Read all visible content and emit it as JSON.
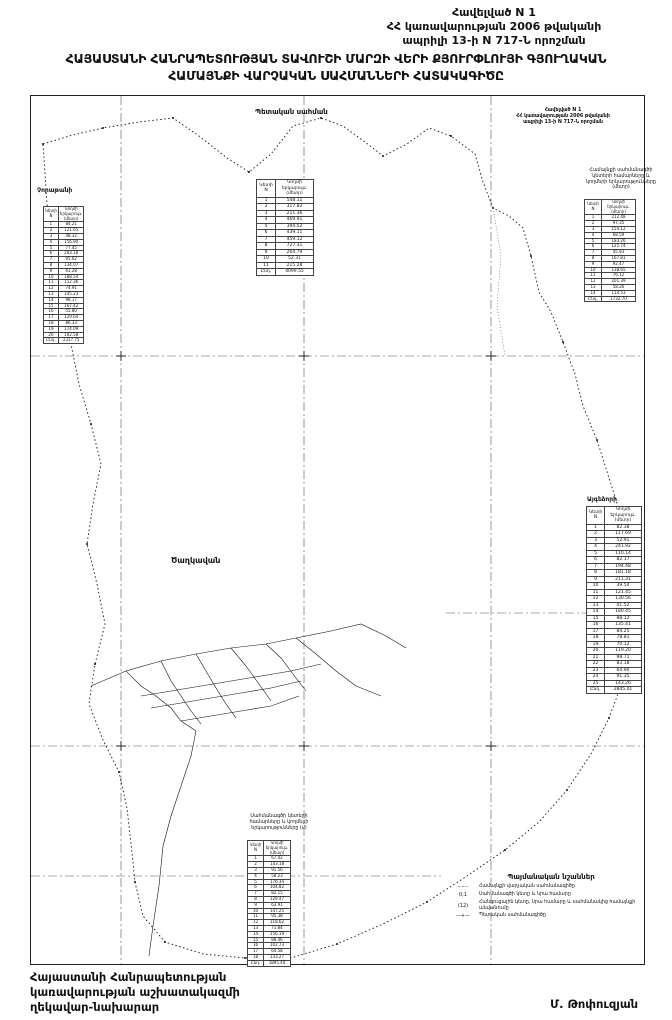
{
  "header": {
    "line1": "Հավելված N 1",
    "line2": "ՀՀ կառավարության 2006 թվականի",
    "line3": "ապրիլի 13-ի N 717-Ն որոշման"
  },
  "title": {
    "line1": "ՀԱՅԱՍՏԱՆԻ ՀԱՆՐԱՊԵՏՈՒԹՅԱՆ ՏԱՎՈՒՇԻ ՄԱՐԶԻ ՎԵՐԻ ՔՅՈՒՐՓԼՈՒՅԻ ԳՅՈՒՂԱԿԱՆ",
    "line2": "ՀԱՄԱՅՆՔԻ ՎԱՐՉԱԿԱՆ ՍԱՀՄԱՆՆԵՐԻ ՀԱՏԱԿԱԳԻԾԸ"
  },
  "map": {
    "corner_note": {
      "line1": "Հավելված N 1",
      "line2": "ՀՀ կառավարության 2006 թվականի",
      "line3": "ապրիլի 13-ի N 717-Ն որոշման"
    },
    "labels": {
      "state_border": "Պետական սահման",
      "village": "Ծաղկավան",
      "west_area": "Չորաթանի",
      "east_area": "Այգեձորի"
    }
  },
  "tables": {
    "col_point": "Կետի N",
    "col_length": "Կողմի երկարութ. (մետր)",
    "north": {
      "rows": [
        [
          "1",
          "548.11"
        ],
        [
          "2",
          "317.82"
        ],
        [
          "3",
          "211.36"
        ],
        [
          "4",
          "469.91"
        ],
        [
          "5",
          "394.52"
        ],
        [
          "6",
          "439.11"
        ],
        [
          "7",
          "459.12"
        ],
        [
          "8",
          "727.31"
        ],
        [
          "9",
          "264.79"
        ],
        [
          "10",
          "52.31"
        ],
        [
          "11",
          "215.28"
        ],
        [
          "Ընդ.",
          "4099.55"
        ]
      ]
    },
    "west": {
      "rows": [
        [
          "1",
          "84.21"
        ],
        [
          "2",
          "121.65"
        ],
        [
          "3",
          "48.32"
        ],
        [
          "4",
          "156.90"
        ],
        [
          "5",
          "77.45"
        ],
        [
          "6",
          "203.18"
        ],
        [
          "7",
          "95.62"
        ],
        [
          "8",
          "134.07"
        ],
        [
          "9",
          "61.28"
        ],
        [
          "10",
          "188.54"
        ],
        [
          "11",
          "112.36"
        ],
        [
          "12",
          "74.91"
        ],
        [
          "13",
          "145.23"
        ],
        [
          "14",
          "98.17"
        ],
        [
          "15",
          "167.42"
        ],
        [
          "16",
          "55.80"
        ],
        [
          "17",
          "129.64"
        ],
        [
          "18",
          "86.33"
        ],
        [
          "19",
          "174.09"
        ],
        [
          "20",
          "102.58"
        ],
        [
          "Ընդ.",
          "2317.75"
        ]
      ]
    },
    "northeast": {
      "caption_lines": [
        "Համայնքի սահմանագծի",
        "կետերի համարները և",
        "կողմերի երկարությունները",
        "(մետր)"
      ],
      "rows": [
        [
          "1",
          "212.48"
        ],
        [
          "2",
          "97.35"
        ],
        [
          "3",
          "154.12"
        ],
        [
          "4",
          "68.59"
        ],
        [
          "5",
          "183.26"
        ],
        [
          "6",
          "121.74"
        ],
        [
          "7",
          "45.93"
        ],
        [
          "8",
          "167.81"
        ],
        [
          "9",
          "92.47"
        ],
        [
          "10",
          "138.65"
        ],
        [
          "11",
          "76.12"
        ],
        [
          "12",
          "201.39"
        ],
        [
          "13",
          "58.26"
        ],
        [
          "14",
          "114.53"
        ],
        [
          "Ընդ.",
          "1732.70"
        ]
      ]
    },
    "east": {
      "rows": [
        [
          "1",
          "82.38"
        ],
        [
          "2",
          "117.69"
        ],
        [
          "3",
          "52.91"
        ],
        [
          "4",
          "241.92"
        ],
        [
          "5",
          "110.14"
        ],
        [
          "6",
          "82.17"
        ],
        [
          "7",
          "194.48"
        ],
        [
          "8",
          "181.18"
        ],
        [
          "9",
          "211.31"
        ],
        [
          "10",
          "39.54"
        ],
        [
          "11",
          "121.45"
        ],
        [
          "12",
          "130.56"
        ],
        [
          "13",
          "41.52"
        ],
        [
          "14",
          "180.45"
        ],
        [
          "15",
          "88.12"
        ],
        [
          "16",
          "135.41"
        ],
        [
          "17",
          "84.25"
        ],
        [
          "18",
          "78.81"
        ],
        [
          "19",
          "70.12"
        ],
        [
          "20",
          "119.20"
        ],
        [
          "21",
          "98.71"
        ],
        [
          "22",
          "83.18"
        ],
        [
          "23",
          "64.90"
        ],
        [
          "24",
          "91.35"
        ],
        [
          "25",
          "143.26"
        ],
        [
          "Ընդ.",
          "2845.01"
        ]
      ]
    },
    "south": {
      "caption_lines": [
        "Սահմանագծի կետերի",
        "համարները և կողմերի",
        "երկարությունները (մ)"
      ],
      "rows": [
        [
          "1",
          "67.42"
        ],
        [
          "2",
          "143.18"
        ],
        [
          "3",
          "91.56"
        ],
        [
          "4",
          "58.23"
        ],
        [
          "5",
          "176.34"
        ],
        [
          "6",
          "104.82"
        ],
        [
          "7",
          "82.15"
        ],
        [
          "8",
          "129.47"
        ],
        [
          "9",
          "63.91"
        ],
        [
          "10",
          "147.25"
        ],
        [
          "11",
          "95.38"
        ],
        [
          "12",
          "118.62"
        ],
        [
          "13",
          "71.84"
        ],
        [
          "14",
          "156.19"
        ],
        [
          "15",
          "88.46"
        ],
        [
          "16",
          "102.73"
        ],
        [
          "17",
          "64.58"
        ],
        [
          "18",
          "133.27"
        ],
        [
          "Ընդ.",
          "1895.40"
        ]
      ]
    }
  },
  "legend": {
    "title": "Պայմանական նշաններ",
    "items": [
      {
        "symbol": "–·–·–",
        "label": "Համայնքի վարչական սահմանագիծը"
      },
      {
        "symbol": "0;1",
        "label": "Սահմանագծի կետը և նրա համարը"
      },
      {
        "symbol": "(12)",
        "label": "Հանգուցային կետը, նրա համարը և սահմանակից համայնքի անվանումը"
      },
      {
        "symbol": "—+—",
        "label": "Պետական սահմանագիծը"
      }
    ]
  },
  "footer": {
    "left_line1": "Հայաստանի Հանրապետության",
    "left_line2": "կառավարության աշխատակազմի",
    "left_line3": "ղեկավար-նախարար",
    "signature": "Մ. Թոփուզյան"
  }
}
